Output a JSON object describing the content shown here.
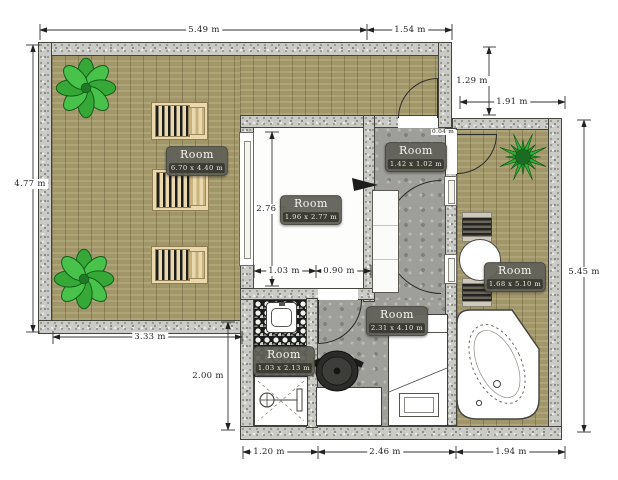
{
  "plan": {
    "rooms": [
      {
        "name": "Room",
        "size": "6.70 x 4.40 m"
      },
      {
        "name": "Room",
        "size": "1.96 x 2.77 m"
      },
      {
        "name": "Room",
        "size": "1.42 x 1.02 m"
      },
      {
        "name": "Room",
        "size": "2.31 x 4.10 m"
      },
      {
        "name": "Room",
        "size": "1.03 x 2.13 m"
      },
      {
        "name": "Room",
        "size": "1.68 x 5.10 m"
      }
    ],
    "dimensions": {
      "top_main": "5.49 m",
      "top_small": "1.54 m",
      "left_side": "4.77 m",
      "right_v_small": "1.29 m",
      "right_h_small": "1.91 m",
      "right_side": "5.45 m",
      "bedroom_height": "2.76 m",
      "bedroom_width_left": "1.03 m",
      "bedroom_width_right": "0.90 m",
      "terrace_width": "3.33 m",
      "bath_height": "2.00 m",
      "bottom_left": "1.20 m",
      "bottom_middle": "2.46 m",
      "bottom_right": "1.94 m",
      "wall_gap": "0.04 m"
    },
    "palette": {
      "wood": "#a89e70",
      "stone": "#9e9e9a",
      "wall_granite": "#cacac6",
      "mosaic_dark": "#1c1c1c",
      "label_bg": "#616159",
      "plant_green": "#3cb043"
    }
  }
}
